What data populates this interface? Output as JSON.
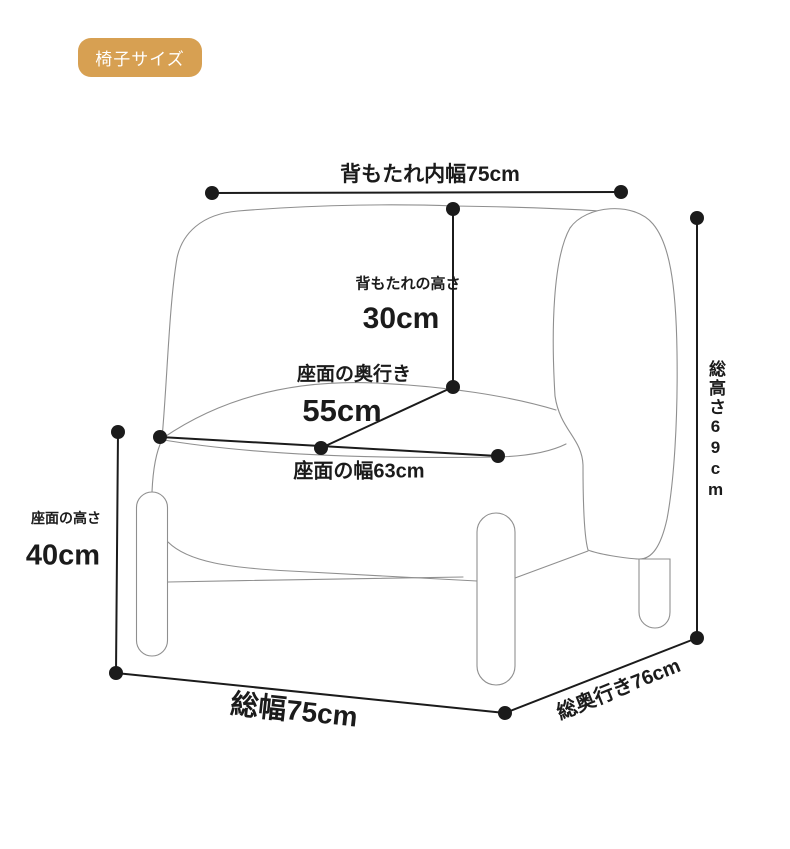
{
  "badge": {
    "label": "椅子サイズ"
  },
  "dimensions": {
    "backrest_inner_width": {
      "label": "背もたれ内幅75cm"
    },
    "backrest_height": {
      "label": "背もたれの高さ",
      "value": "30cm"
    },
    "seat_depth": {
      "label": "座面の奥行き",
      "value": "55cm"
    },
    "seat_width": {
      "label": "座面の幅63cm"
    },
    "seat_height": {
      "label": "座面の高さ",
      "value": "40cm"
    },
    "total_height": {
      "label": "総高さ69cm"
    },
    "total_width": {
      "label": "総幅75cm"
    },
    "total_depth": {
      "label": "総奥行き76cm"
    }
  },
  "colors": {
    "badge_bg": "#d7a052",
    "badge_text": "#ffffff",
    "dimension": "#1b1b1b",
    "chair_outline": "#8f8f8f",
    "background": "#ffffff"
  }
}
